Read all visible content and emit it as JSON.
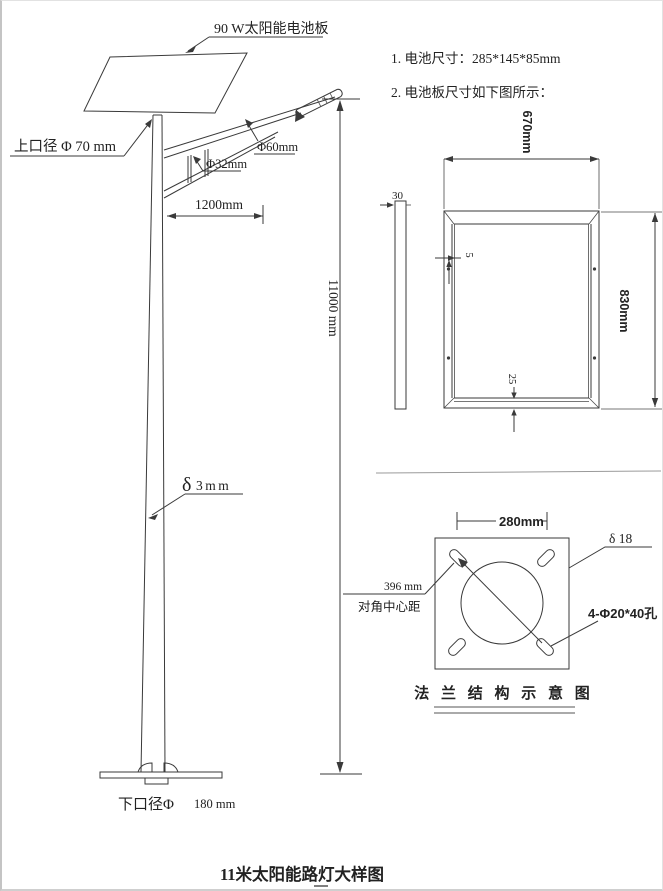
{
  "page": {
    "title": "11米太阳能路灯大样图"
  },
  "notes": {
    "line1": "1. 电池尺寸：285*145*85mm",
    "line2": "2. 电池板尺寸如下图所示："
  },
  "pole_figure": {
    "panel_label": "90 W太阳能电池板",
    "top_diameter": "上口径 Φ 70 mm",
    "arm_tube": "Φ60mm",
    "brace_tube": "Φ32mm",
    "arm_length": "1200mm",
    "height": "11000 mm",
    "wall_delta": "δ",
    "wall_value": "3mm",
    "bottom_diameter_label": "下口径Φ",
    "bottom_diameter_value": "180 mm"
  },
  "panel_figure": {
    "thickness": "30",
    "width": "670mm",
    "height": "830mm",
    "frame_side": "5",
    "frame_bottom": "25"
  },
  "flange_figure": {
    "width": "280mm",
    "thickness": "δ 18",
    "holes": "4-Φ20*40孔",
    "diagonal_value": "396 mm",
    "diagonal_label": "对角中心距",
    "caption": "法 兰 结 构 示 意 图"
  },
  "colors": {
    "line": "#3a3a3a",
    "text": "#222222"
  }
}
